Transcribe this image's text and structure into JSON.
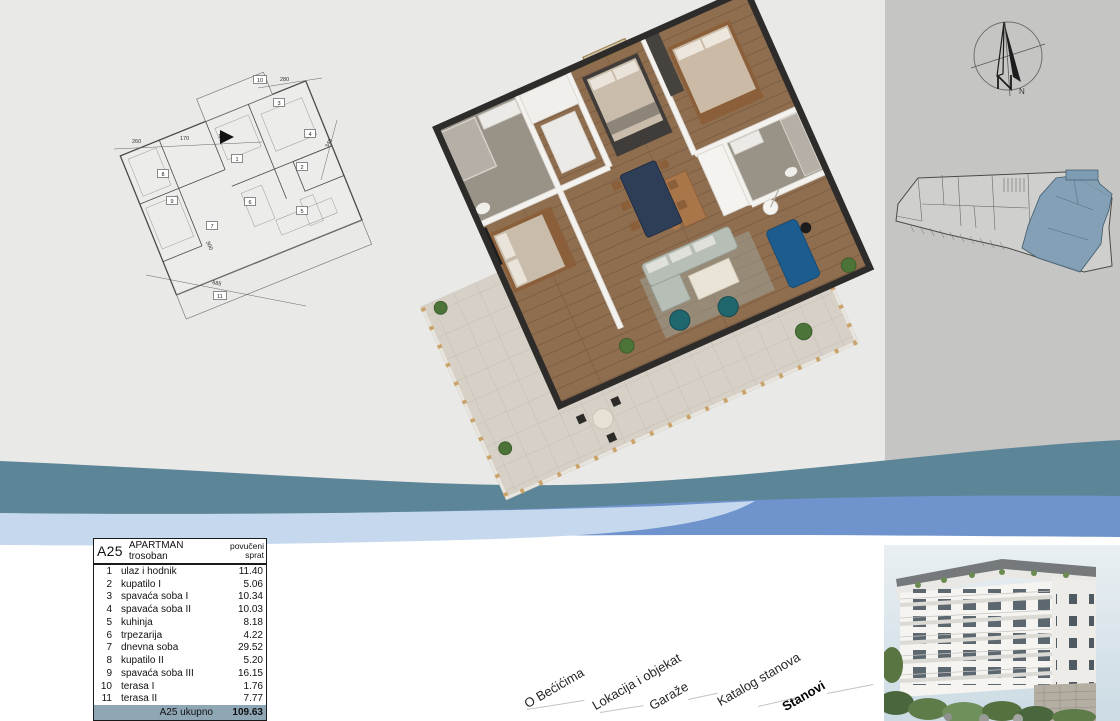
{
  "colors": {
    "background": "#e9e9e7",
    "right_panel": "#c5c5c3",
    "wave_teal": "#5d8598",
    "wave_light_blue": "#c5d8ee",
    "wave_blue": "#6f94cd",
    "table_total_bg": "#8fa6b4",
    "key_plan_highlight": "#7d9cb4"
  },
  "table": {
    "unit": "A25",
    "type_label": "APARTMAN trosoban",
    "floor_label": "povučeni sprat",
    "rows": [
      {
        "num": "1",
        "name": "ulaz i hodnik",
        "area": "11.40"
      },
      {
        "num": "2",
        "name": "kupatilo I",
        "area": "5.06"
      },
      {
        "num": "3",
        "name": "spavaća soba I",
        "area": "10.34"
      },
      {
        "num": "4",
        "name": "spavaća soba II",
        "area": "10.03"
      },
      {
        "num": "5",
        "name": "kuhinja",
        "area": "8.18"
      },
      {
        "num": "6",
        "name": "trpezarija",
        "area": "4.22"
      },
      {
        "num": "7",
        "name": "dnevna soba",
        "area": "29.52"
      },
      {
        "num": "8",
        "name": "kupatilo II",
        "area": "5.20"
      },
      {
        "num": "9",
        "name": "spavaća soba III",
        "area": "16.15"
      },
      {
        "num": "10",
        "name": "terasa I",
        "area": "1.76"
      },
      {
        "num": "11",
        "name": "terasa II",
        "area": "7.77"
      }
    ],
    "total_label": "A25 ukupno",
    "total_value": "109.63"
  },
  "nav": {
    "items": [
      {
        "label": "O Bećićima"
      },
      {
        "label": "Lokacija i objekat"
      },
      {
        "label": "Garaže"
      },
      {
        "label": "Katalog stanova"
      },
      {
        "label": "Stanovi",
        "bold": true
      }
    ]
  },
  "plan2d": {
    "tags": [
      "1",
      "2",
      "3",
      "4",
      "5",
      "6",
      "7",
      "8",
      "9",
      "10",
      "11"
    ],
    "dims": [
      "260",
      "170",
      "190",
      "280",
      "340",
      "300",
      "685"
    ]
  },
  "compass": {
    "letter": "N"
  }
}
